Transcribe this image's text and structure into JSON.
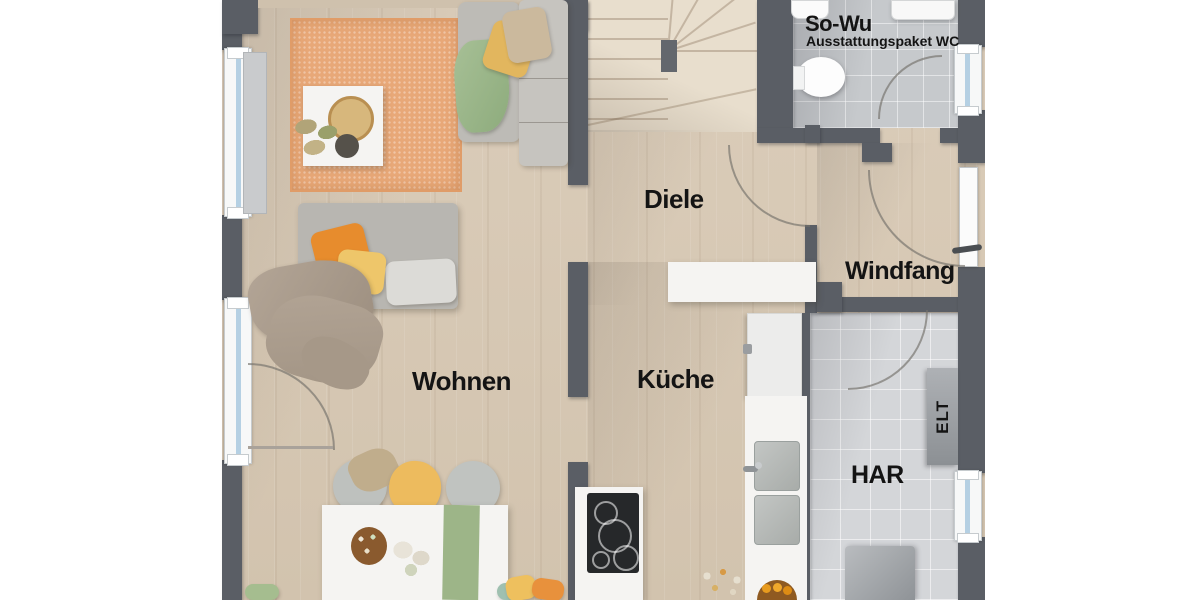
{
  "plan": {
    "rooms": {
      "wc": {
        "title": "So-Wu",
        "subtitle": "Ausstattungspaket WC"
      },
      "diele": {
        "name": "Diele"
      },
      "windfang": {
        "name": "Windfang"
      },
      "wohnen": {
        "name": "Wohnen"
      },
      "kueche": {
        "name": "Küche"
      },
      "har": {
        "name": "HAR"
      },
      "elt": {
        "name": "ELT"
      }
    },
    "colors": {
      "wall": "#5a5e65",
      "wood_floor": "#d7c9b5",
      "stair_wood": "#e8decd",
      "tile_wc": "#c6c9cc",
      "tile_har": "#d4d6d9",
      "rug_orange": "#e8a878",
      "sofa_gray": "#bdbbb6",
      "accent_orange": "#e78c2d",
      "accent_yellow": "#eec66a",
      "accent_green": "#9cb88c",
      "runner_green": "#9db588",
      "window_glass": "#b5d0e3",
      "label_text": "#141414"
    }
  }
}
